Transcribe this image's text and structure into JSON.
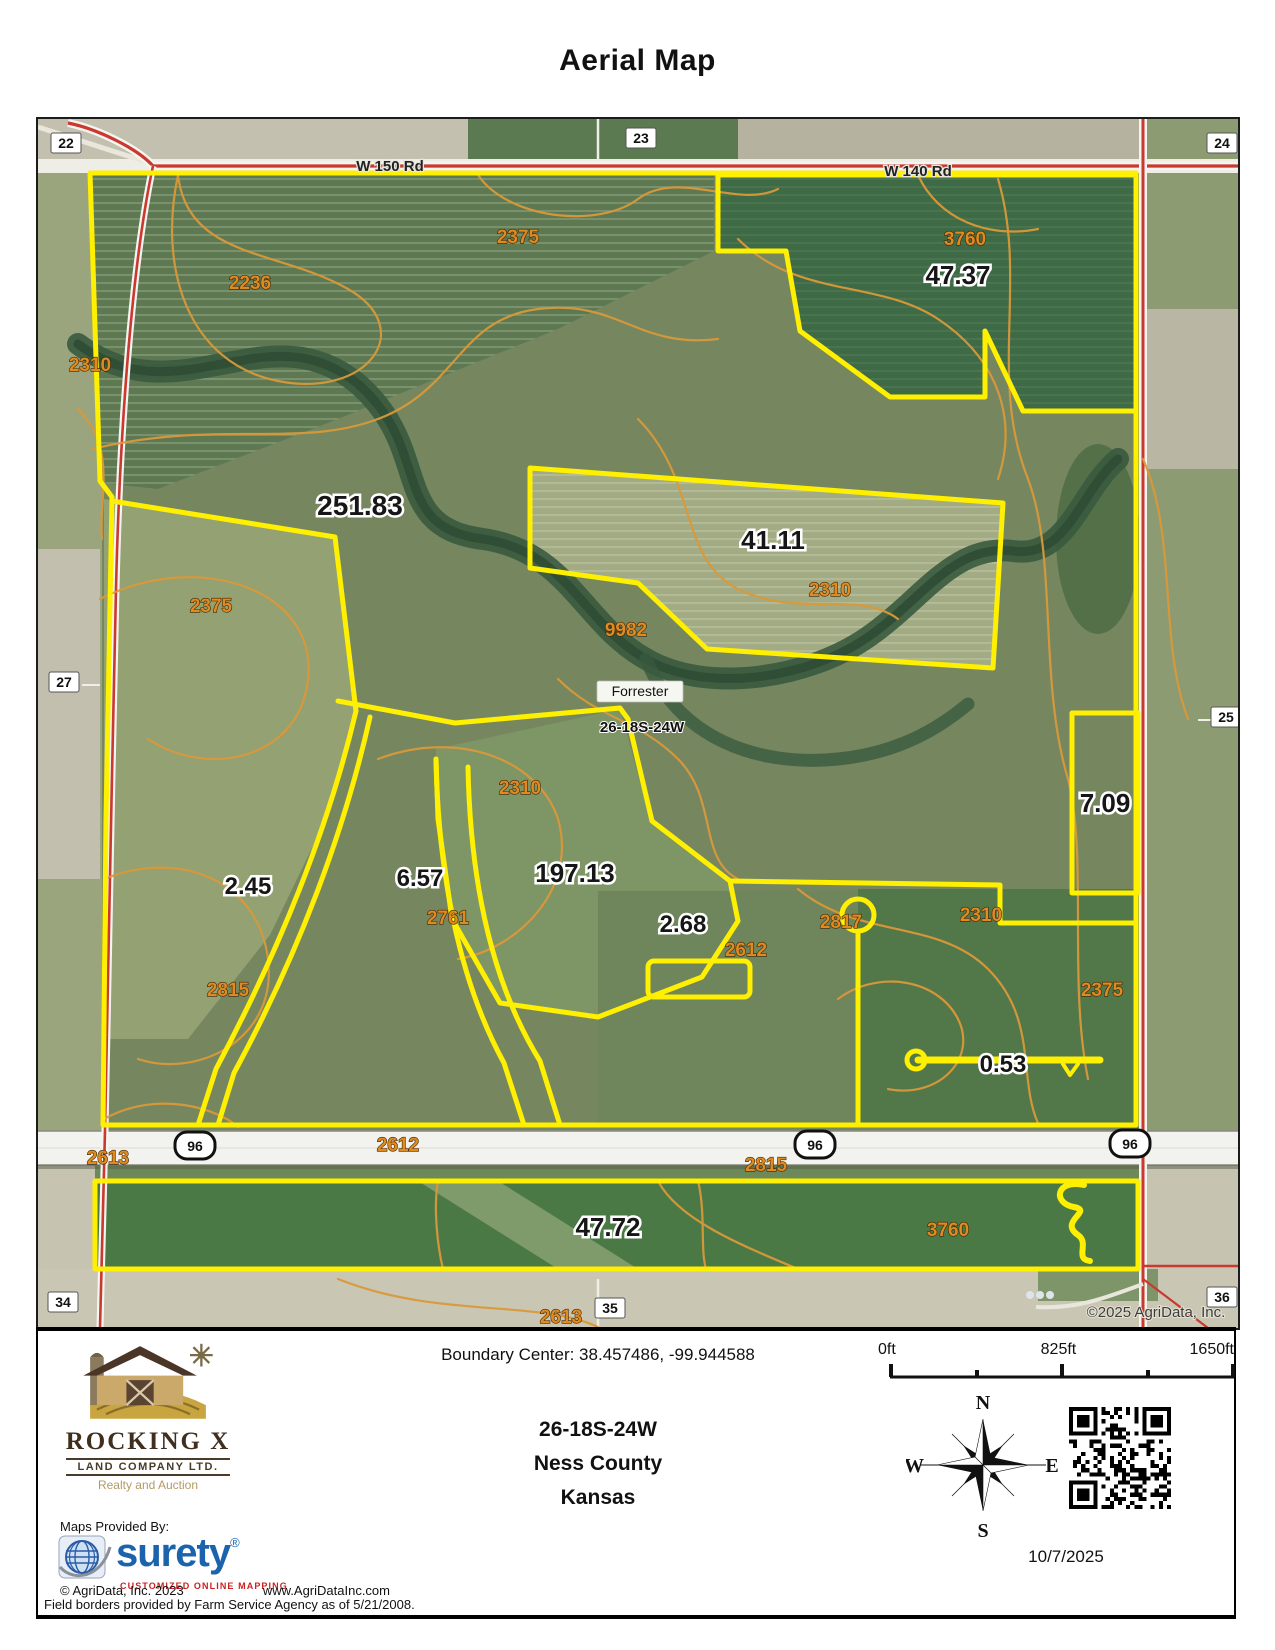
{
  "title": "Aerial Map",
  "colors": {
    "boundary_yellow": "#ffef00",
    "contour_orange": "#e08a22",
    "road_red": "#c9392f",
    "surety_blue": "#1b63ac",
    "surety_red": "#cc2020"
  },
  "map": {
    "acreage_labels": [
      {
        "text": "251.83",
        "x": 322,
        "y": 396,
        "size": 28
      },
      {
        "text": "47.37",
        "x": 920,
        "y": 165,
        "size": 26
      },
      {
        "text": "41.11",
        "x": 735,
        "y": 430,
        "size": 26
      },
      {
        "text": "197.13",
        "x": 537,
        "y": 763,
        "size": 26
      },
      {
        "text": "7.09",
        "x": 1067,
        "y": 693,
        "size": 26
      },
      {
        "text": "2.45",
        "x": 210,
        "y": 775,
        "size": 24
      },
      {
        "text": "6.57",
        "x": 382,
        "y": 767,
        "size": 24
      },
      {
        "text": "2.68",
        "x": 645,
        "y": 813,
        "size": 24
      },
      {
        "text": "0.53",
        "x": 965,
        "y": 953,
        "size": 24
      },
      {
        "text": "47.72",
        "x": 570,
        "y": 1117,
        "size": 26
      }
    ],
    "contour_labels": [
      {
        "text": "2236",
        "x": 212,
        "y": 170
      },
      {
        "text": "2310",
        "x": 52,
        "y": 252
      },
      {
        "text": "2375",
        "x": 480,
        "y": 124
      },
      {
        "text": "3760",
        "x": 927,
        "y": 126
      },
      {
        "text": "2375",
        "x": 173,
        "y": 493
      },
      {
        "text": "2310",
        "x": 792,
        "y": 477
      },
      {
        "text": "9982",
        "x": 588,
        "y": 517
      },
      {
        "text": "2310",
        "x": 482,
        "y": 675
      },
      {
        "text": "2761",
        "x": 410,
        "y": 805
      },
      {
        "text": "2815",
        "x": 190,
        "y": 877
      },
      {
        "text": "2817",
        "x": 803,
        "y": 809
      },
      {
        "text": "2612",
        "x": 708,
        "y": 837
      },
      {
        "text": "2310",
        "x": 943,
        "y": 802
      },
      {
        "text": "2375",
        "x": 1064,
        "y": 877
      },
      {
        "text": "2613",
        "x": 70,
        "y": 1045
      },
      {
        "text": "2612",
        "x": 360,
        "y": 1032
      },
      {
        "text": "2815",
        "x": 728,
        "y": 1052
      },
      {
        "text": "3760",
        "x": 910,
        "y": 1117
      },
      {
        "text": "2613",
        "x": 523,
        "y": 1204
      }
    ],
    "section_labels": [
      {
        "text": "22",
        "x": 28,
        "y": 27
      },
      {
        "text": "23",
        "x": 603,
        "y": 22
      },
      {
        "text": "24",
        "x": 1184,
        "y": 27
      },
      {
        "text": "27",
        "x": 26,
        "y": 566
      },
      {
        "text": "25",
        "x": 1188,
        "y": 601
      },
      {
        "text": "34",
        "x": 25,
        "y": 1186
      },
      {
        "text": "35",
        "x": 572,
        "y": 1192
      },
      {
        "text": "36",
        "x": 1184,
        "y": 1181
      }
    ],
    "road_labels": [
      {
        "text": "W 150 Rd",
        "x": 352,
        "y": 52
      },
      {
        "text": "W 140 Rd",
        "x": 880,
        "y": 57
      }
    ],
    "highway_shields": [
      {
        "text": "96",
        "x": 157,
        "y": 1027
      },
      {
        "text": "96",
        "x": 777,
        "y": 1026
      },
      {
        "text": "96",
        "x": 1092,
        "y": 1025
      }
    ],
    "place_label": {
      "text": "Forrester",
      "x": 602,
      "y": 577
    },
    "township_label": {
      "text": "26-18S-24W",
      "x": 604,
      "y": 613
    },
    "copyright": {
      "text": "©2025 AgriData, Inc.",
      "x": 1118,
      "y": 1198
    }
  },
  "footer": {
    "boundary_center": "Boundary Center: 38.457486, -99.944588",
    "legal_description": "26-18S-24W",
    "county": "Ness County",
    "state": "Kansas",
    "scale_labels": [
      "0ft",
      "825ft",
      "1650ft"
    ],
    "compass": {
      "north": "N",
      "east": "E",
      "south": "S",
      "west": "W"
    },
    "date": "10/7/2025",
    "rocking_x": {
      "name": "ROCKING X",
      "subtitle": "LAND COMPANY LTD.",
      "tagline": "Realty and Auction"
    },
    "maps_provided_by": "Maps Provided By:",
    "surety": {
      "name": "surety",
      "registered": "®",
      "tagline": "CUSTOMIZED ONLINE MAPPING"
    },
    "agridata_copyright": "© AgriData, Inc. 2023",
    "agridata_url": "www.AgriDataInc.com",
    "field_borders_note": "Field borders provided by Farm Service Agency as of 5/21/2008."
  }
}
